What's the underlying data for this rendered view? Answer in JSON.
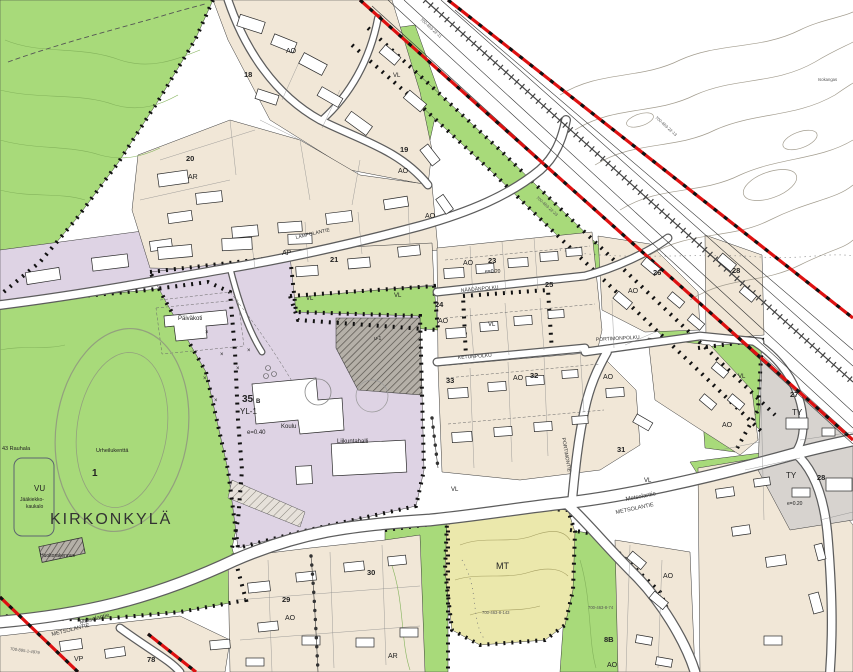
{
  "map": {
    "region_title": "KIRKONKYLÄ",
    "zone_codes": {
      "vl": "VL",
      "vu": "VU",
      "vp": "VP",
      "mt": "MT",
      "ty": "TY",
      "ao": "AO",
      "ar": "AR",
      "ap": "AP",
      "yl1": "YL-1",
      "u1": "u-1"
    },
    "block_numbers": {
      "n1": "1",
      "n18": "18",
      "n19": "19",
      "n20": "20",
      "n21": "21",
      "n23": "23",
      "n24": "24",
      "n25": "25",
      "n26": "26",
      "n27": "27",
      "n28": "28",
      "n29": "29",
      "n30": "30",
      "n31": "31",
      "n32": "32",
      "n33": "33",
      "n35": "35",
      "n35_sub": "B",
      "n8b": "8B",
      "n78": "78"
    },
    "densities": {
      "e040": "e=0.40",
      "e020": "e=0.20"
    },
    "streets": {
      "metsolantie": "Metsolantie",
      "metsolantie_caps": "METSOLANTIE",
      "ketunpolku": "KETUNPOLKU",
      "naadanpolku": "NÄÄDÄNPOLKU",
      "portimonpolku": "PORTIMONPOLKU",
      "portimontie": "PORTIMONTIE",
      "lampolantie": "LAMPOLANTIE"
    },
    "places": {
      "paivakoti": "Päiväkoti",
      "koulu": "Koulu",
      "liikuntahalli": "Liikuntahalli",
      "urheilukentta": "Urheilukenttä",
      "jaakiekko_line1": "Jääkiekko-",
      "jaakiekko_line2": "kaukalo",
      "huoltorakennus": "Huoltorakennus",
      "rauhala": "43 Rauhala",
      "isokangas": "Isokangas"
    },
    "parcels": {
      "p1": "700-463-22-11",
      "p2": "700-463-22-23",
      "p3": "700-463-8-143",
      "p4": "700-463-8-74",
      "p5": "700-895-1-4979",
      "p6": "700-463-22-13"
    },
    "colors": {
      "recreation_green": "#a8da7a",
      "residential_beige": "#f1e7d7",
      "public_lavender": "#ded3e4",
      "industrial_gray": "#d7d3cf",
      "agriculture_yellow": "#ebe8ac",
      "boundary_red": "#dd1111"
    }
  }
}
